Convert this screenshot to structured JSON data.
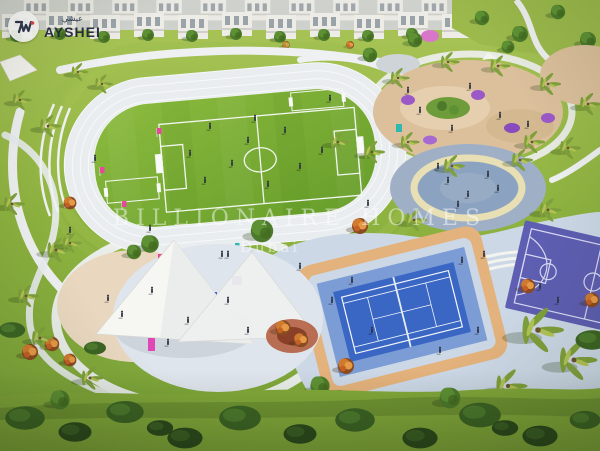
{
  "logo": {
    "brand": "AYSHEI",
    "brand_arabic": "عيشي",
    "icon": "ayshei-monogram-icon",
    "accent_red": "#d93a3a",
    "mark_navy": "#232b46"
  },
  "watermark": {
    "line1": "BILLIONAIRE HOMES",
    "line2": "Dubai"
  },
  "colors": {
    "lawn_green": "#8db23f",
    "field_green": "#74a832",
    "track_surface": "#e9edf0",
    "path_white": "#eef0f2",
    "plaza_blue_grey": "#9fb0c6",
    "plaza_ring_cream": "#e8e0b4",
    "paving_light_blue": "#ccd8e6",
    "tennis_court_blue": "#3a66c4",
    "tennis_apron_blue": "#7b9cd4",
    "court_border_tan": "#e4b27c",
    "basketball_court_purple": "#5e5eb2",
    "playground_sand": "#dcc09c",
    "canopy_white": "#f6f6f3"
  }
}
